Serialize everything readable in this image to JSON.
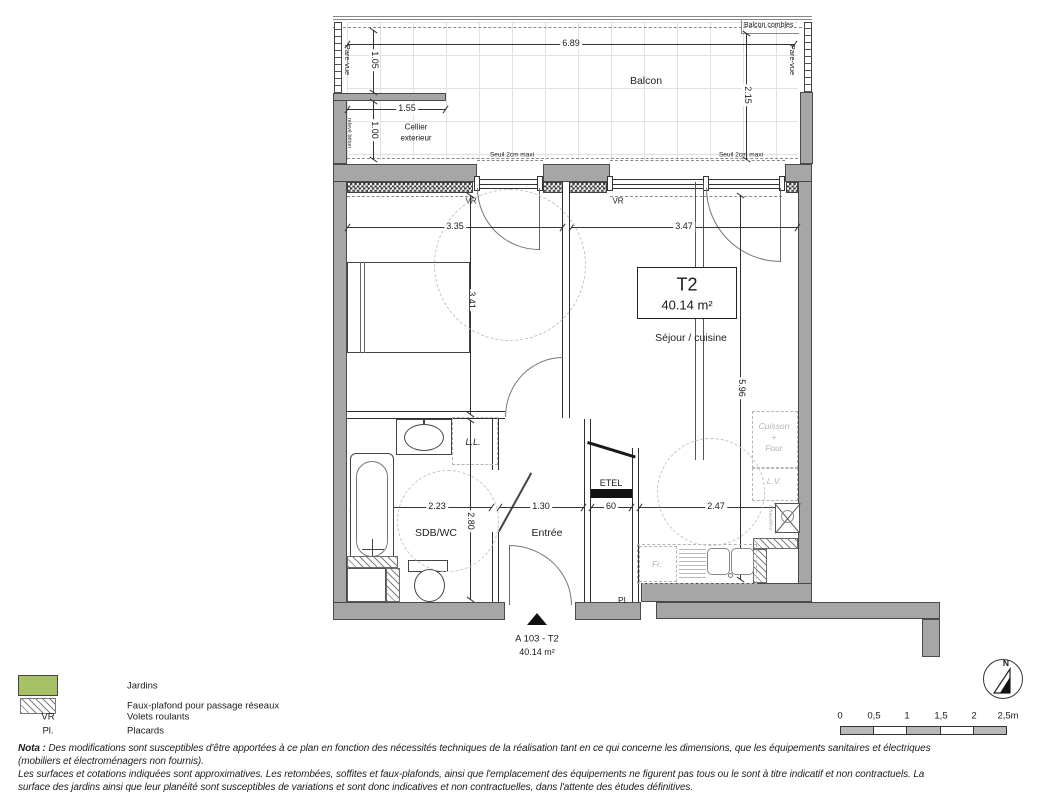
{
  "colors": {
    "wall_gray": "#a6a6a6",
    "jardins_green": "#a7c167",
    "kitchen_gray": "#b3b3b3",
    "line": "#333333"
  },
  "balcony": {
    "label": "Balcon",
    "combles": "Balcon combles",
    "pare_vue_left": "Pare-vue",
    "pare_vue_right": "Pare-vue",
    "releve_beton": "relevé béton",
    "cellier_l1": "Cellier",
    "cellier_l2": "exterieur",
    "seuil_left": "Seuil 2cm maxi",
    "seuil_right": "Seuil 2cm maxi"
  },
  "rooms": {
    "chambre": "Chambre",
    "sejour": "Séjour / cuisine",
    "sdb": "SDB/WC",
    "entree": "Entrée",
    "etel": "ETEL",
    "placard": "Pl.",
    "lave_linge": "L.L."
  },
  "kitchen": {
    "cuisson_l1": "Cuisson",
    "cuisson_l2": "+",
    "cuisson_l3": "Four",
    "lave_vaisselle": "L.V.",
    "frigo": "Fr.",
    "chaudiere": "Chaudière"
  },
  "windows": {
    "vr_left": "VR",
    "vr_right": "VR"
  },
  "unit": {
    "type": "T2",
    "area": "40.14 m²",
    "footer_ref": "A 103 - T2",
    "footer_area": "40.14 m²"
  },
  "dims": {
    "balcon_w": "6.89",
    "balcon_d": "2.15",
    "d105": "1.05",
    "d100": "1.00",
    "d155": "1.55",
    "chambre_w": "3.35",
    "sejour_w": "3.47",
    "chambre_h": "3.41",
    "sejour_h": "5.96",
    "sdb_w": "2.23",
    "sdb_h": "2.80",
    "entree_w": "1.30",
    "etel_w": "60",
    "cuisine_w": "2.47"
  },
  "legend": {
    "items": [
      {
        "key": "",
        "label": "Jardins"
      },
      {
        "key": "",
        "label": "Faux-plafond pour passage réseaux"
      },
      {
        "key": "VR",
        "label": "Volets roulants"
      },
      {
        "key": "Pl.",
        "label": "Placards"
      }
    ]
  },
  "compass": {
    "north": "N"
  },
  "scalebar": {
    "ticks": [
      "0",
      "0,5",
      "1",
      "1,5",
      "2",
      "2,5m"
    ]
  },
  "nota": {
    "label": "Nota :",
    "line1": "Des modifications sont susceptibles d'être apportées à ce plan en fonction des nécessités techniques de la réalisation tant en ce qui concerne les dimensions, que les équipements sanitaires et électriques",
    "line2": "(mobiliers et électroménagers non fournis).",
    "line3": "Les surfaces et cotations indiquées sont approximatives. Les retombées, soffites et faux-plafonds, ainsi que l'emplacement des équipements ne figurent pas tous ou le sont à titre indicatif et non contractuels. La",
    "line4": "surface des jardins ainsi que leur planéité sont susceptibles de variations et sont donc indicatives et non contractuelles, dans l'attente des études définitives."
  }
}
